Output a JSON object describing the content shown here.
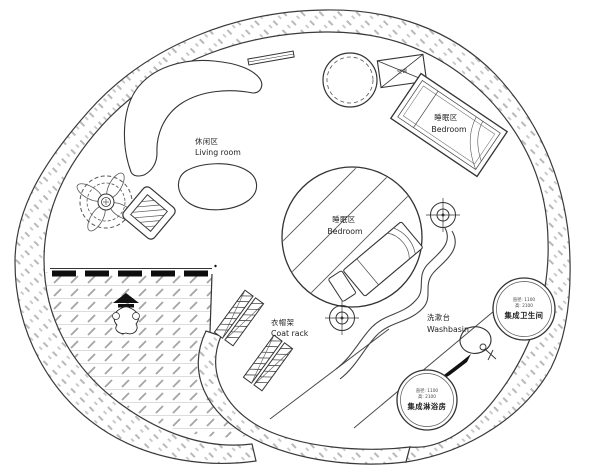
{
  "plan": {
    "areas": {
      "living_room": {
        "zh": "休闲区",
        "en": "Living room"
      },
      "bedroom_upper": {
        "zh": "睡眠区",
        "en": "Bedroom"
      },
      "bedroom_center": {
        "zh": "睡眠区",
        "en": "Bedroom"
      },
      "coat_rack": {
        "zh": "衣帽架",
        "en": "Coat rack"
      },
      "washbasin": {
        "zh": "洗漱台",
        "en": "Washbasin"
      },
      "bathroom_pod": {
        "name": "集成卫生间",
        "dim_line1": "直径: 1100",
        "dim_line2": "高: 2100"
      },
      "shower_pod": {
        "name": "集成淋浴房",
        "dim_line1": "直径: 1100",
        "dim_line2": "高: 2100"
      },
      "ac_unit": {
        "label": "空调"
      }
    },
    "colors": {
      "wall_line": "#3a3a3a",
      "wall_hatch": "#b9b9b9",
      "deck_hatch": "#9a9a9a",
      "text": "#222222"
    }
  }
}
